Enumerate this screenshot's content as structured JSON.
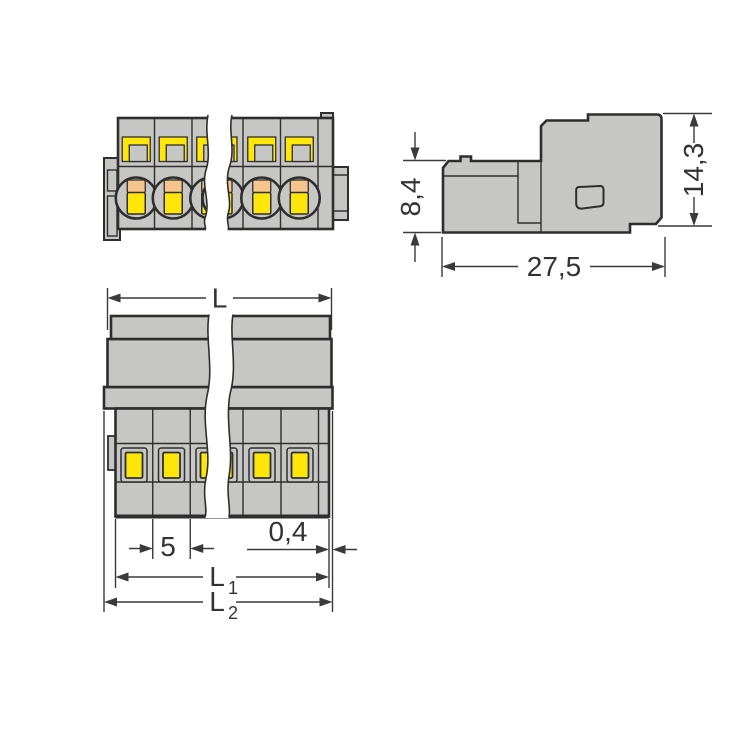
{
  "colors": {
    "bg": "#ffffff",
    "body": "#c6c7c5",
    "yellow": "#ffe60a",
    "orange": "#f6c58c",
    "line": "#2e2e2e",
    "dim": "#3a3a3a",
    "text": "#333333"
  },
  "views": {
    "side": {
      "dims": {
        "height_lower": "8,4",
        "height_overall": "14,3",
        "depth": "27,5"
      }
    },
    "bottom": {
      "dims": {
        "length": "L",
        "pitch": "5",
        "edge_offset": "0,4",
        "l1_base": "L",
        "l1_sub": "1",
        "l2_base": "L",
        "l2_sub": "2"
      }
    }
  }
}
